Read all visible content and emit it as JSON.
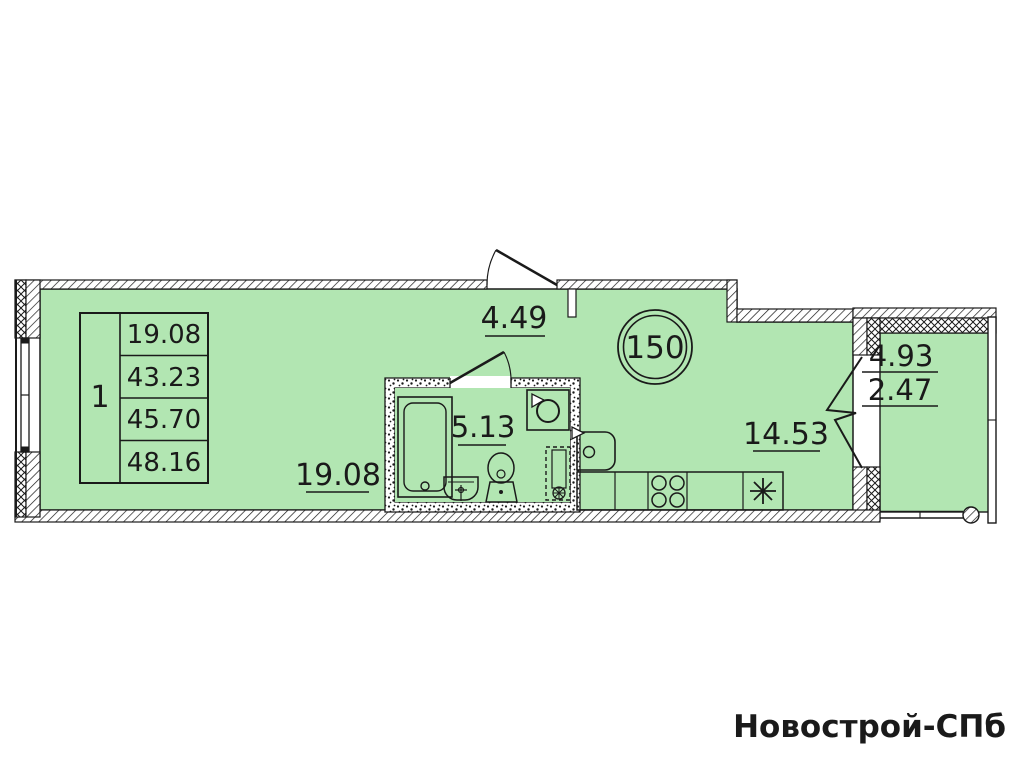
{
  "unit": {
    "number": "150"
  },
  "area_table": {
    "rooms": "1",
    "values": [
      "19.08",
      "43.23",
      "45.70",
      "48.16"
    ]
  },
  "room_areas": {
    "hallway": "4.49",
    "bathroom": "5.13",
    "living_room": "19.08",
    "kitchen": "14.53",
    "balcony_full": "4.93",
    "balcony_reduced": "2.47"
  },
  "watermark": "Новострой-СПб",
  "colors": {
    "floor_fill": "#b2e6b2",
    "line": "#1a1a1a",
    "watermark": "#ededed"
  }
}
